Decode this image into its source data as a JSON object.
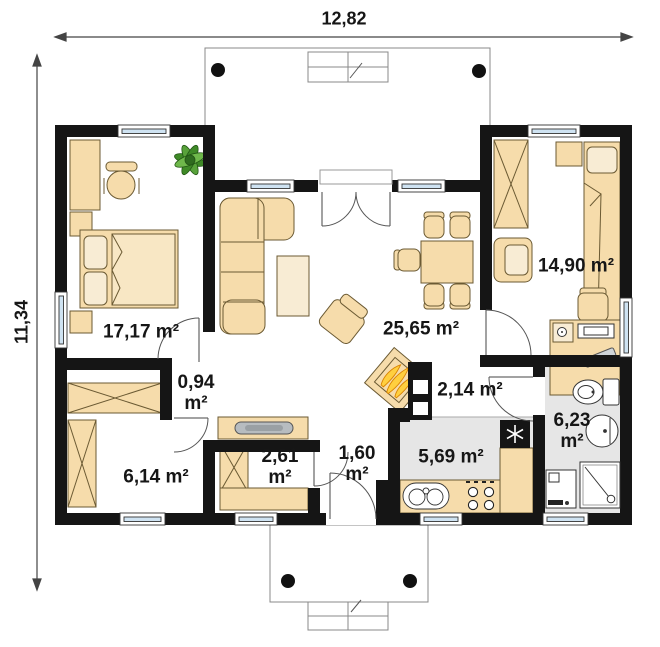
{
  "dimensions": {
    "width_label": "12,82",
    "height_label": "11,34"
  },
  "rooms": [
    {
      "id": "bedroom-left",
      "label": "17,17 m²"
    },
    {
      "id": "vestibule",
      "line1": "0,94",
      "line2": "m²"
    },
    {
      "id": "wardrobe-room",
      "label": "6,14 m²"
    },
    {
      "id": "closet-room",
      "line1": "2,61",
      "line2": "m²"
    },
    {
      "id": "entry-hall",
      "line1": "1,60",
      "line2": "m²"
    },
    {
      "id": "living-room",
      "label": "25,65 m²"
    },
    {
      "id": "kitchen",
      "label": "5,69 m²"
    },
    {
      "id": "hallway",
      "label": "2,14 m²"
    },
    {
      "id": "bathroom",
      "line1": "6,23",
      "line2": "m²"
    },
    {
      "id": "bedroom-right",
      "label": "14,90 m²"
    }
  ],
  "icons": {
    "plant": "plant-icon",
    "fireplace": "fireplace-flames-icon",
    "fridge": "snowflake-icon",
    "sink": "kitchen-sink-icon",
    "stove": "stove-burners-icon",
    "toilet": "toilet-icon",
    "washbasin": "washbasin-icon",
    "shower": "shower-icon",
    "washing_machine": "washing-machine-icon",
    "radiator": "radiator-icon",
    "column": "column-dot-icon"
  },
  "colors": {
    "wall": "#151515",
    "furniture": "#f6dcab",
    "furniture_light": "#f8ecd4",
    "glass": "#cfe3f2",
    "floor_grey": "#e6e6e6",
    "plant_green": "#3f8a27",
    "flame_yellow": "#ffcf3f",
    "flame_orange": "#d98200",
    "metal_grey": "#b7bcc0",
    "line_grey": "#888888"
  }
}
